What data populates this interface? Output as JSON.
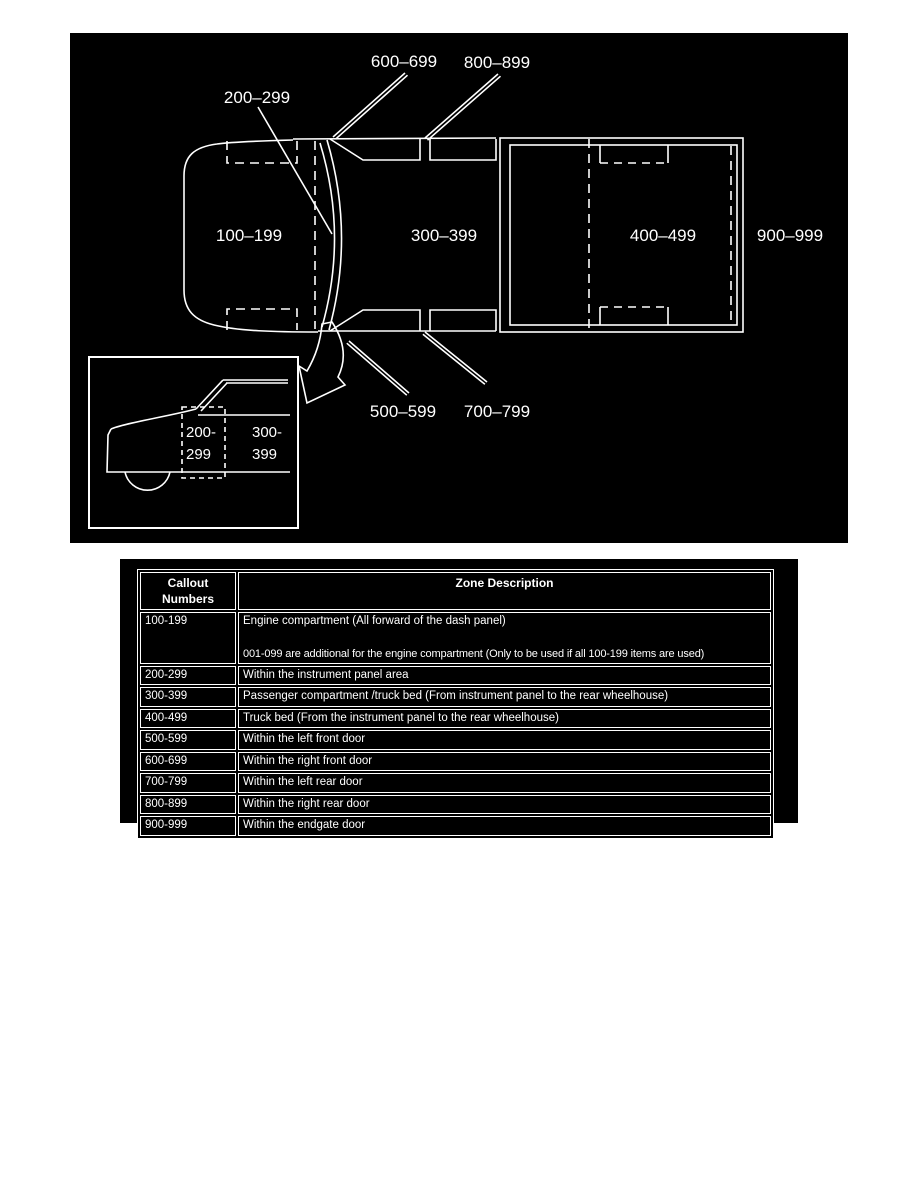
{
  "colors": {
    "page_background": "#ffffff",
    "panel_background": "#000000",
    "line_and_text": "#ffffff"
  },
  "diagram": {
    "zone_labels": {
      "z100": "100–199",
      "z200": "200–299",
      "z300": "300–399",
      "z400": "400–499",
      "z500": "500–599",
      "z600": "600–699",
      "z700": "700–799",
      "z800": "800–899",
      "z900": "900–999"
    },
    "inset_labels": {
      "top_left": "200-",
      "bottom_left": "299",
      "top_right": "300-",
      "bottom_right": "399"
    }
  },
  "table": {
    "headers": [
      "Callout Numbers",
      "Zone Description"
    ],
    "rows": [
      {
        "callout": "100-199",
        "desc": "Engine compartment (All forward of the dash panel)",
        "desc2": "001-099 are additional for the engine compartment (Only to be used if all 100-199 items are used)"
      },
      {
        "callout": "200-299",
        "desc": "Within the instrument panel area"
      },
      {
        "callout": "300-399",
        "desc": "Passenger compartment /truck bed (From instrument panel to the rear wheelhouse)"
      },
      {
        "callout": "400-499",
        "desc": "Truck bed (From the instrument panel to the rear wheelhouse)"
      },
      {
        "callout": "500-599",
        "desc": "Within the left front door"
      },
      {
        "callout": "600-699",
        "desc": "Within the right front door"
      },
      {
        "callout": "700-799",
        "desc": "Within the left rear door"
      },
      {
        "callout": "800-899",
        "desc": "Within the right rear door"
      },
      {
        "callout": "900-999",
        "desc": "Within the endgate door"
      }
    ]
  }
}
